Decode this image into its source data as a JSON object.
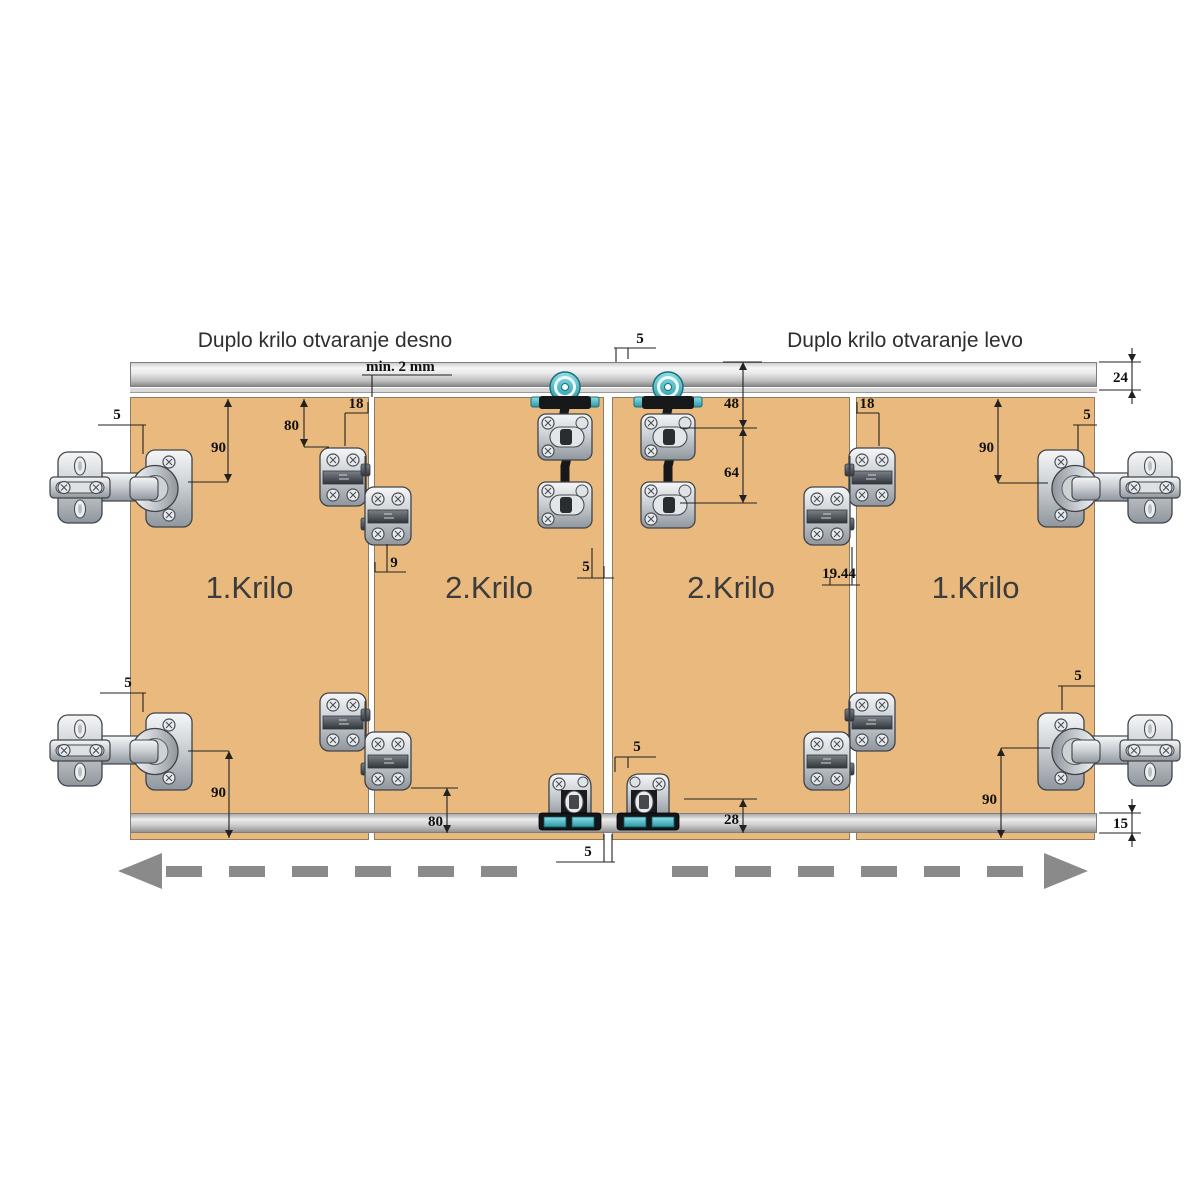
{
  "titles": {
    "left": "Duplo krilo otvaranje desno",
    "right": "Duplo krilo otvaranje levo"
  },
  "panels": [
    {
      "label": "1.Krilo"
    },
    {
      "label": "2.Krilo"
    },
    {
      "label": "2.Krilo"
    },
    {
      "label": "1.Krilo"
    }
  ],
  "dims": {
    "rail_top": "24",
    "rail_bottom": "15",
    "min_gap": "min. 2 mm",
    "top_left_edge": "5",
    "top_left_hinge": "90",
    "top_left_mid": "80",
    "top_left_inset": "18",
    "mid_left_gap": "9",
    "center_top_gap": "5",
    "center_roller_upper": "48",
    "center_roller_lower": "64",
    "center_plate_gap": "5",
    "mid_right_gap": "19.44",
    "top_right_inset": "18",
    "top_right_hinge": "90",
    "top_right_edge": "5",
    "bottom_left_edge": "5",
    "bottom_left_hinge": "90",
    "bottom_left_mid": "80",
    "bottom_center_gap_top": "5",
    "bottom_center_guide": "28",
    "bottom_center_gap": "5",
    "bottom_right_edge": "5",
    "bottom_right_hinge": "90"
  },
  "hardware_icons": {
    "roller": "hanger-roller-icon",
    "side_hinge": "cup-hinge-icon",
    "face_hinge": "fold-hinge-icon",
    "bottom_guide": "bottom-guide-icon"
  },
  "colors": {
    "panel": "#e9b97e",
    "rail": "#c9c9c9",
    "teal": "#35a7b5",
    "arrow": "#8a8a8a",
    "dim_text": "#101010"
  }
}
